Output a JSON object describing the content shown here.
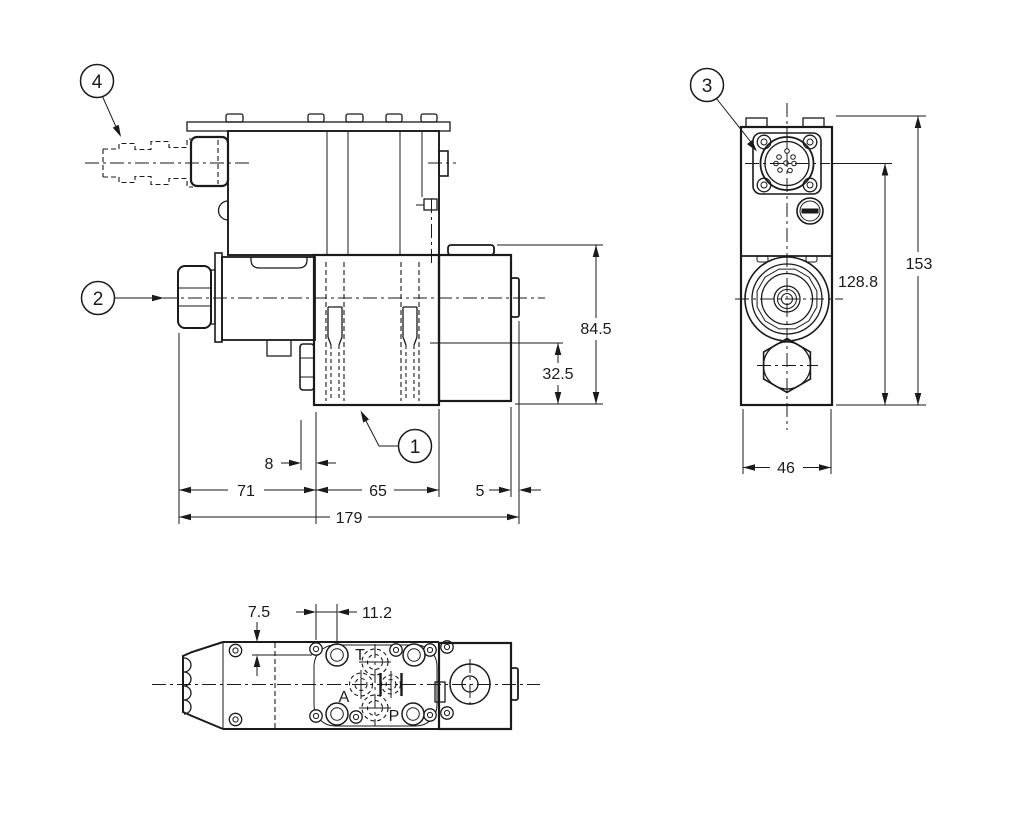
{
  "colors": {
    "line": "#1a1a1a",
    "background": "#ffffff"
  },
  "callouts": {
    "item1": "1",
    "item2": "2",
    "item3": "3",
    "item4": "4"
  },
  "front_view": {
    "dim_84_5": "84.5",
    "dim_32_5": "32.5",
    "dim_8": "8",
    "dim_71": "71",
    "dim_65": "65",
    "dim_5": "5",
    "dim_179": "179"
  },
  "side_view": {
    "dim_153": "153",
    "dim_128_8": "128.8",
    "dim_46": "46"
  },
  "bottom_view": {
    "dim_7_5": "7.5",
    "dim_11_2": "11.2",
    "port_t": "T",
    "port_a": "A",
    "port_p": "P"
  }
}
